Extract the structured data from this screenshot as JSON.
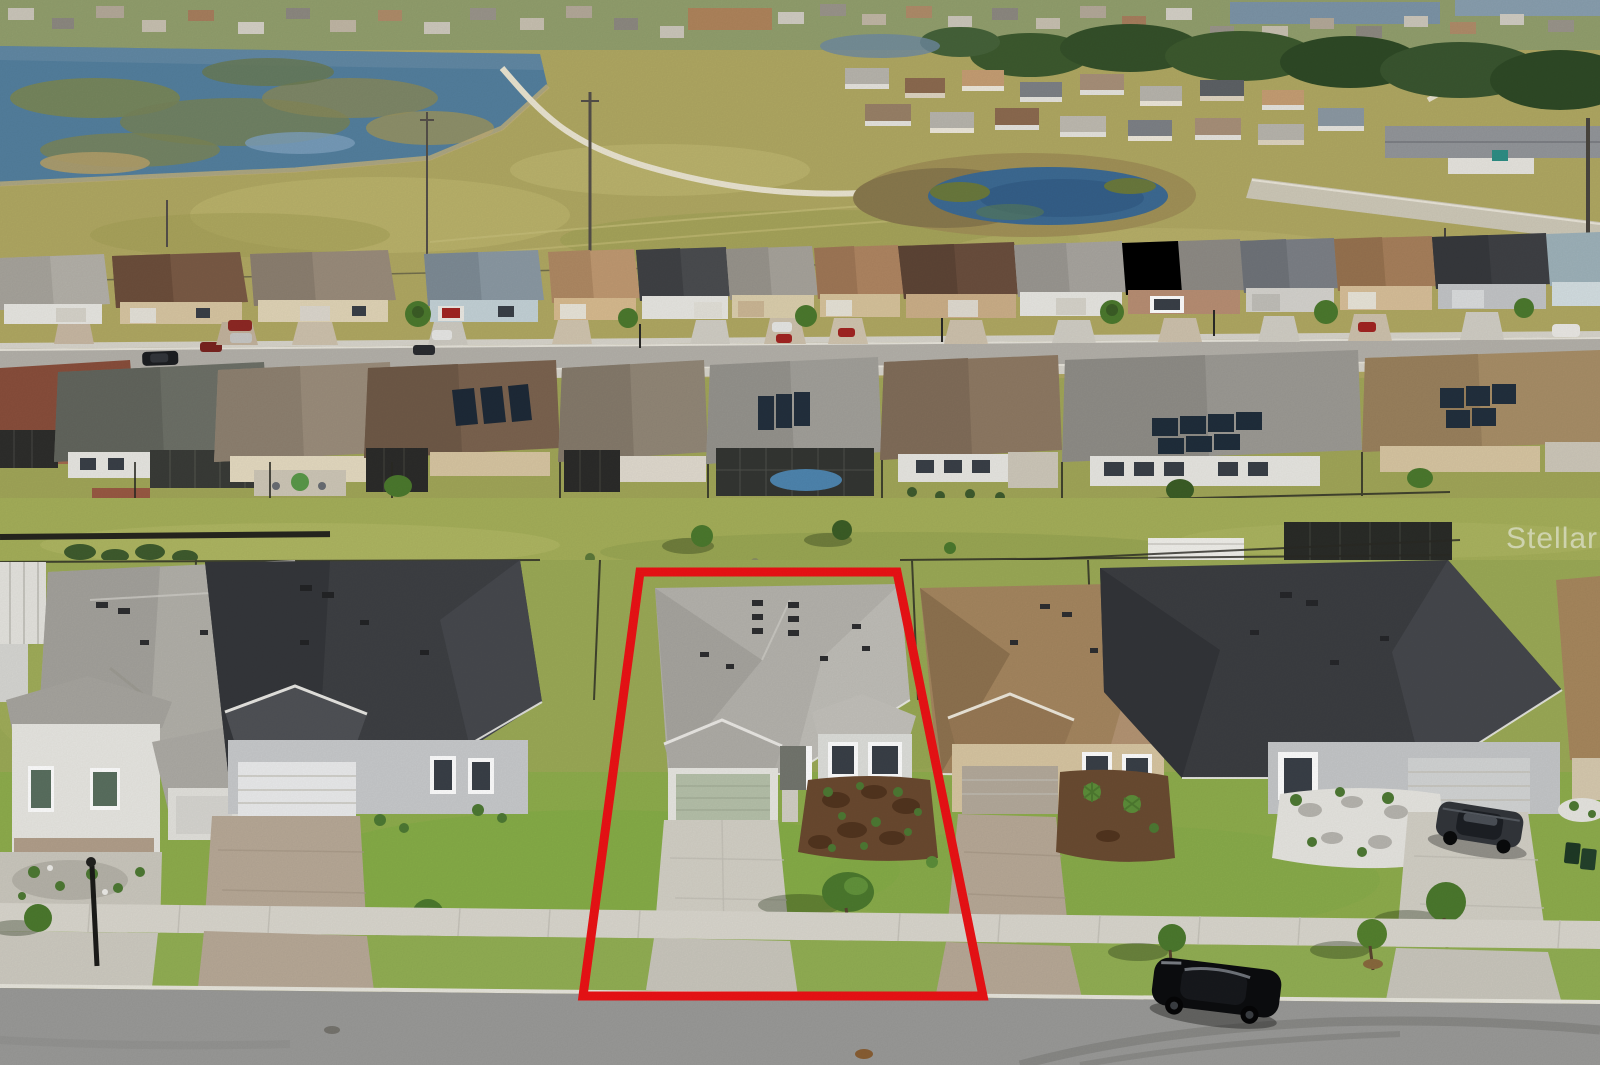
{
  "watermark": {
    "text": "StellarMLS",
    "color": "#ffffff"
  },
  "highlight": {
    "label": "subject property boundary",
    "color": "#ee1216"
  },
  "palette": {
    "field": "#b1a963",
    "field-light": "#c3bb72",
    "field-dark": "#99a051",
    "lake": "#54809f",
    "marsh": "#7b8757",
    "pond": "#3d6b94",
    "road": "#9b9b99",
    "road1": "#b5b2ab",
    "sidewalk": "#dbd8cf",
    "concrete": "#d4d1c7",
    "paver": "#b9aa98",
    "grass": "#8fae4d",
    "grass-yellow": "#a6b05a",
    "grass-bright": "#7fb042",
    "roof-gray": "#b4b2ac",
    "roof-dark": "#3d3f43",
    "roof-brown": "#8a6a50",
    "roof-tan": "#a98a62",
    "roof-red": "#8d5240",
    "wall-white": "#e9e8e3",
    "wall-tan": "#d9c7a3",
    "garage-sage": "#b7c2ab",
    "tree": "#4c7a2e",
    "tree-dark": "#3c5e26",
    "fence": "#2b2b24",
    "mulch": "#6b4a30",
    "white-rock": "#e8e7e2"
  },
  "scene": {
    "type": "aerial real-estate photograph",
    "description": "Drone view of a single-family home community; the subject lot is outlined in red",
    "regions": {
      "top_left": "lake with marsh islands and distant lakefront homes",
      "top_middle": "golf-course style open field with cart path and power poles",
      "top_right": "neighborhood cluster, tree line and retention pond",
      "middle": "two facing rows of single-story homes along an upper street",
      "greenbelt": "grassy common strip with fences, shrubs and a white canopy",
      "bottom": "front row of homes on the lower street; subject home outlined"
    },
    "subject_property": {
      "roof": "light gray shingle hip roof",
      "garage_door": "sage green two-car door",
      "landscaping": "brown mulch beds with young shrubs",
      "driveway": "concrete, crossing sidewalk to street"
    },
    "vehicles": {
      "street_parked": "black sedan on lower street, right of subject lot",
      "driveway_parked": "dark gray coupe on right neighbor driveway",
      "upper_street": "assorted cars in driveways and at curbs"
    }
  }
}
